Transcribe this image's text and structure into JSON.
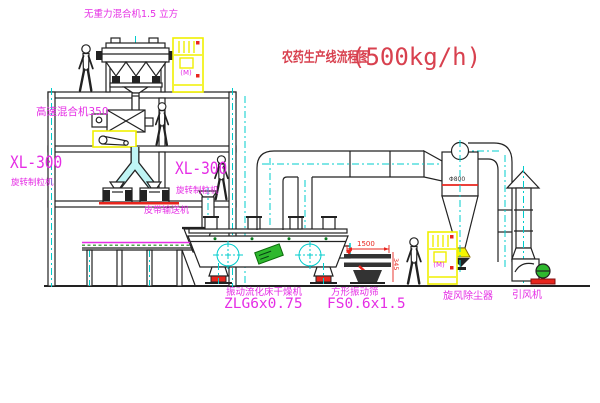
{
  "canvas": {
    "width": 600,
    "height": 403,
    "background": "#ffffff"
  },
  "title": {
    "name_cn": "农药生产线流程图",
    "capacity": "(500kg/h)"
  },
  "labels": {
    "gravity_mixer": "无重力混合机1.5 立方",
    "high_speed_mixer": "高速混合机350",
    "mill_left_model": "XL-300",
    "mill_left_name": "旋转制粒机",
    "mill_right_model": "XL-300",
    "mill_right_name": "旋转制粒机",
    "belt_conveyor": "皮带输送机",
    "dryer_name": "振动流化床干燥机",
    "dryer_model": "ZLG6x0.75",
    "sieve_name": "方形振动筛",
    "sieve_model": "FS0.6x1.5",
    "cyclone_name": "旋风除尘器",
    "fan_name": "引风机"
  },
  "annotations": {
    "cyclone_dim": "Φ800",
    "sieve_dim_length": "1500",
    "sieve_dim_height": "345",
    "cabinet_marking": "(M)"
  },
  "colors": {
    "label_magenta": "#e52ee5",
    "title_red": "#d8414f",
    "dimension_red": "#e8251d",
    "centerline_cyan": "#00cccc",
    "cabinet_yellow": "#f0f000",
    "machine_green": "#2eb82e",
    "line_black": "#222222"
  }
}
